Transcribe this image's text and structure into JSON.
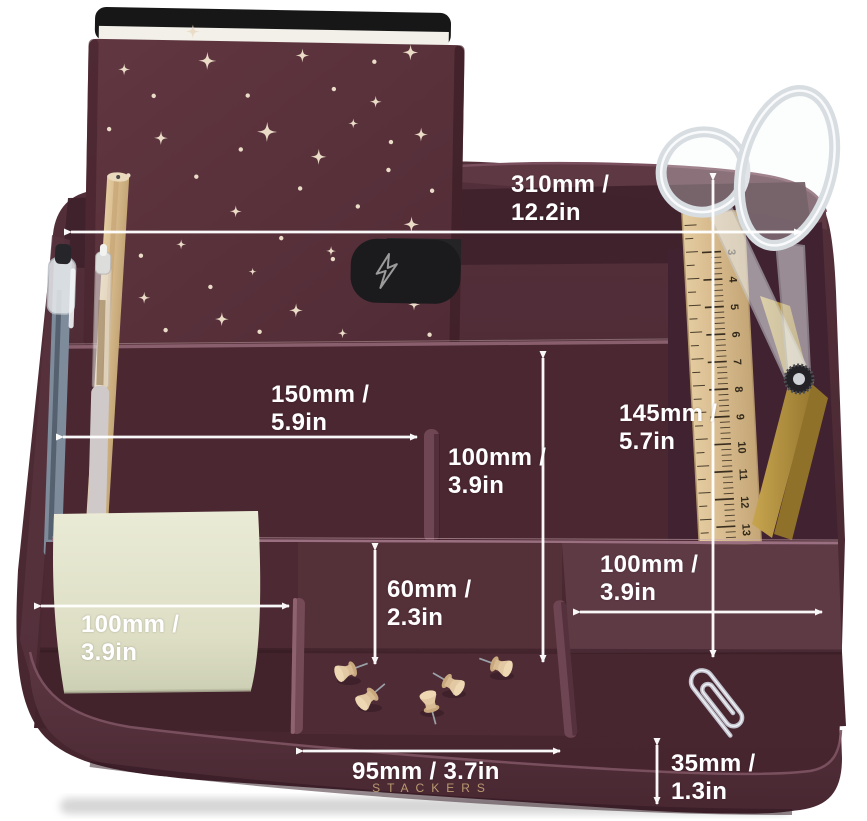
{
  "product": {
    "brand_label": "STACKERS",
    "colors": {
      "body_burgundy": "#4E2B36",
      "body_dark": "#3C1F29",
      "body_light": "#5E3A45",
      "annotation_white": "#FFFFFF",
      "brand_gold": "#CDAD7A",
      "notebook_cover": "#5C333D",
      "star_cream": "#EADCC7",
      "sticky_note": "#E3E4CB",
      "wood_tan": "#D9BB92",
      "scissor_gold": "#B3913F"
    }
  },
  "annotations": [
    {
      "id": "back-width",
      "text": "310mm /\n12.2in"
    },
    {
      "id": "left-compartment-width",
      "text": "150mm /\n5.9in"
    },
    {
      "id": "middle-compartment-height",
      "text": "100mm /\n3.9in"
    },
    {
      "id": "right-compartment-height",
      "text": "145mm /\n5.7in"
    },
    {
      "id": "right-compartment-width",
      "text": "100mm /\n3.9in"
    },
    {
      "id": "front-left-width",
      "text": "100mm /\n3.9in"
    },
    {
      "id": "front-tray-depth",
      "text": "60mm /\n2.3in"
    },
    {
      "id": "front-middle-width",
      "text": "95mm / 3.7in"
    },
    {
      "id": "front-wall-height",
      "text": "35mm /\n1.3in"
    }
  ],
  "ruler": {
    "numbers": [
      "3",
      "4",
      "5",
      "6",
      "7",
      "8",
      "9",
      "10",
      "11",
      "12",
      "13"
    ]
  }
}
